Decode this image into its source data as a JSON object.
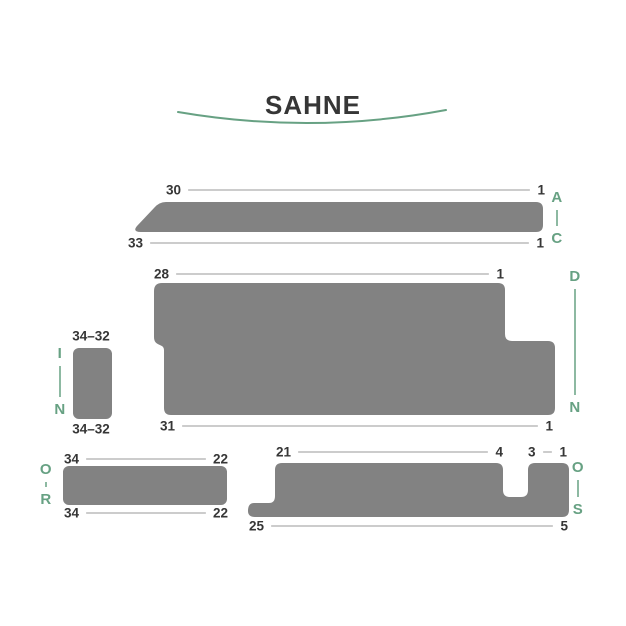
{
  "title": "SAHNE",
  "colors": {
    "shape_gray": "#828282",
    "accent_green": "#67a183",
    "label_dark": "#363636",
    "dim_line": "#9a9a9a",
    "background": "#ffffff"
  },
  "parts": {
    "top_bar": {
      "top_dim": {
        "start": "30",
        "end": "1"
      },
      "bottom_dim": {
        "start": "33",
        "end": "1"
      },
      "letters": {
        "top": "A",
        "bottom": "C"
      }
    },
    "large_middle": {
      "top_dim": {
        "start": "28",
        "end": "1"
      },
      "bottom_dim": {
        "start": "31",
        "end": "1"
      },
      "letters": {
        "top": "D",
        "bottom": "N"
      }
    },
    "small_left": {
      "top_label": "34–32",
      "bottom_label": "34–32",
      "letters": {
        "top": "I",
        "bottom": "N"
      }
    },
    "bottom_left": {
      "top_dim": {
        "start": "34",
        "end": "22"
      },
      "bottom_dim": {
        "start": "34",
        "end": "22"
      },
      "letters": {
        "top": "O",
        "bottom": "R"
      }
    },
    "bottom_right": {
      "top_dim_left": {
        "start": "21",
        "end": "4"
      },
      "top_dim_right": {
        "start": "3",
        "end": "1"
      },
      "bottom_dim": {
        "start": "25",
        "end": "5"
      },
      "letters": {
        "top": "O",
        "bottom": "S"
      }
    }
  }
}
